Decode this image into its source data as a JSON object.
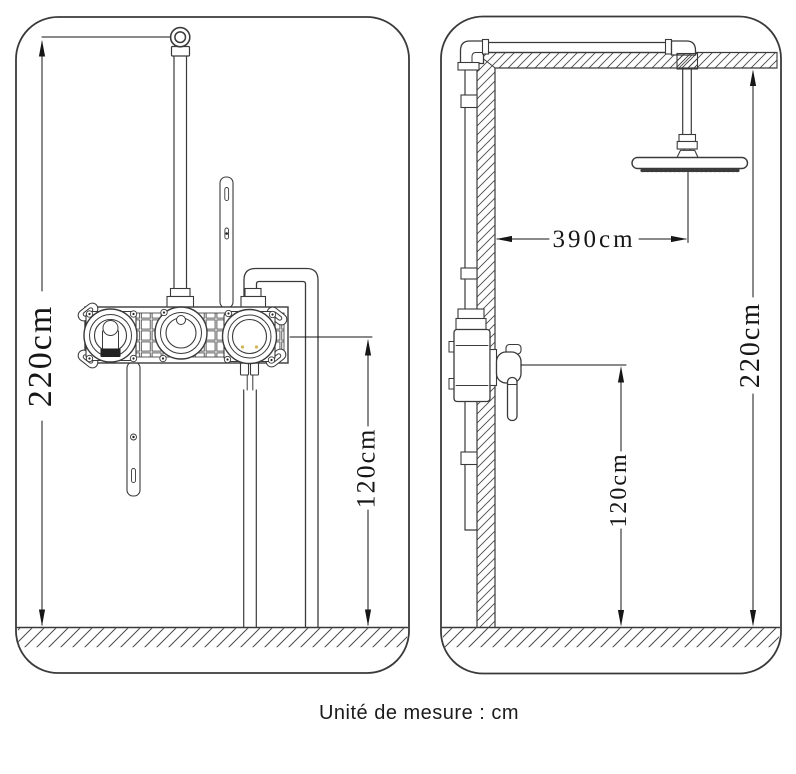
{
  "footer": {
    "note": "Unité de mesure : cm"
  },
  "dimensions": {
    "front_view": {
      "total_height": "220cm",
      "valve_height": "120cm"
    },
    "side_view": {
      "wall_to_head": "390cm",
      "total_height": "220cm",
      "valve_height": "120cm"
    }
  },
  "colors": {
    "line": "#3a3a3a",
    "dimension": "#161616",
    "background": "#ffffff"
  }
}
